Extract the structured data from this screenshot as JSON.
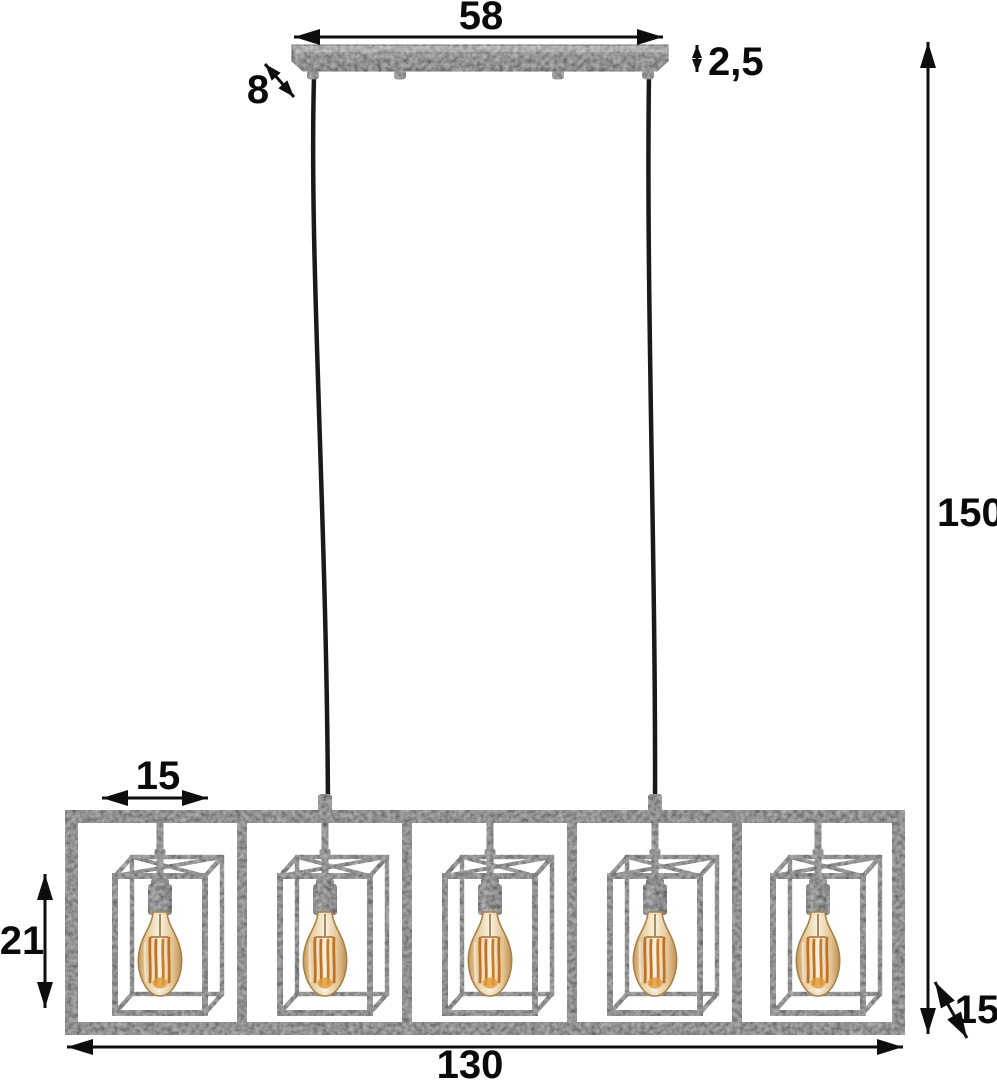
{
  "diagram": {
    "kind": "product-dimension-diagram",
    "subject": "pendant lamp with five cube cage shades and filament bulbs",
    "background": "#ffffff"
  },
  "lamp": {
    "shade_count": 5,
    "bulb_count": 5,
    "cable_count": 2
  },
  "dimensions": {
    "ceiling_mount_width": "58",
    "ceiling_mount_height": "2,5",
    "ceiling_mount_depth": "8",
    "hanging_height": "150",
    "shade_width": "15",
    "shade_height": "21",
    "fixture_width": "130",
    "shade_depth": "15"
  },
  "colors": {
    "dimension_lines": "#0e0e0e",
    "dimension_text": "#0a0a0a",
    "metal_base": "#4c4b4a",
    "metal_highlight": "#8a8987",
    "cable": "#191919",
    "socket": "#3a3a3a",
    "bulb_glass_center": "#f8f0dc",
    "bulb_glass_edge": "#c2934f",
    "filament": "#bf7227",
    "background": "#ffffff"
  }
}
